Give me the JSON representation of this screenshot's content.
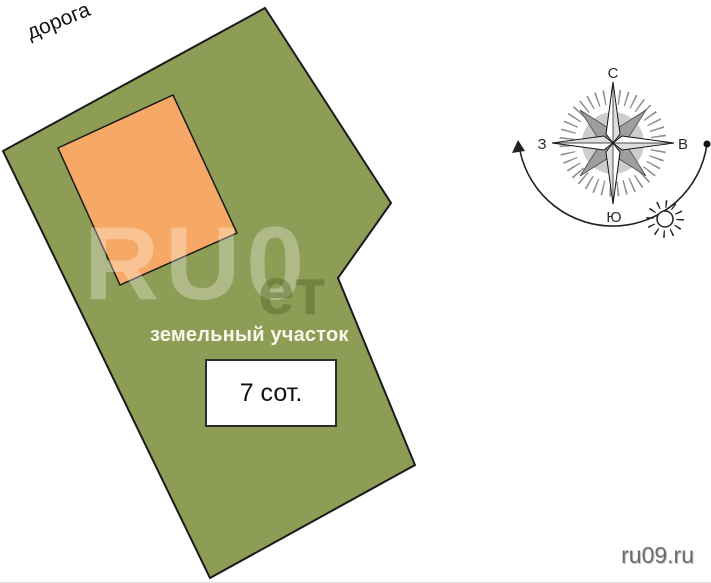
{
  "plan": {
    "road_label": "дорога",
    "plot_label": "земельный участок",
    "area_label": "7 сот."
  },
  "compass": {
    "north": "С",
    "east": "В",
    "south": "Ю",
    "west": "З"
  },
  "watermark": {
    "large": "RU0",
    "small": "ет"
  },
  "footer": {
    "site": "ru09.ru"
  },
  "colors": {
    "plot_green": "#8e9d55",
    "building_orange": "#f6a966",
    "outline_dark": "#1a1a1a",
    "compass_gray": "#9e9e9e",
    "tick_gray": "#8f8f8f"
  }
}
